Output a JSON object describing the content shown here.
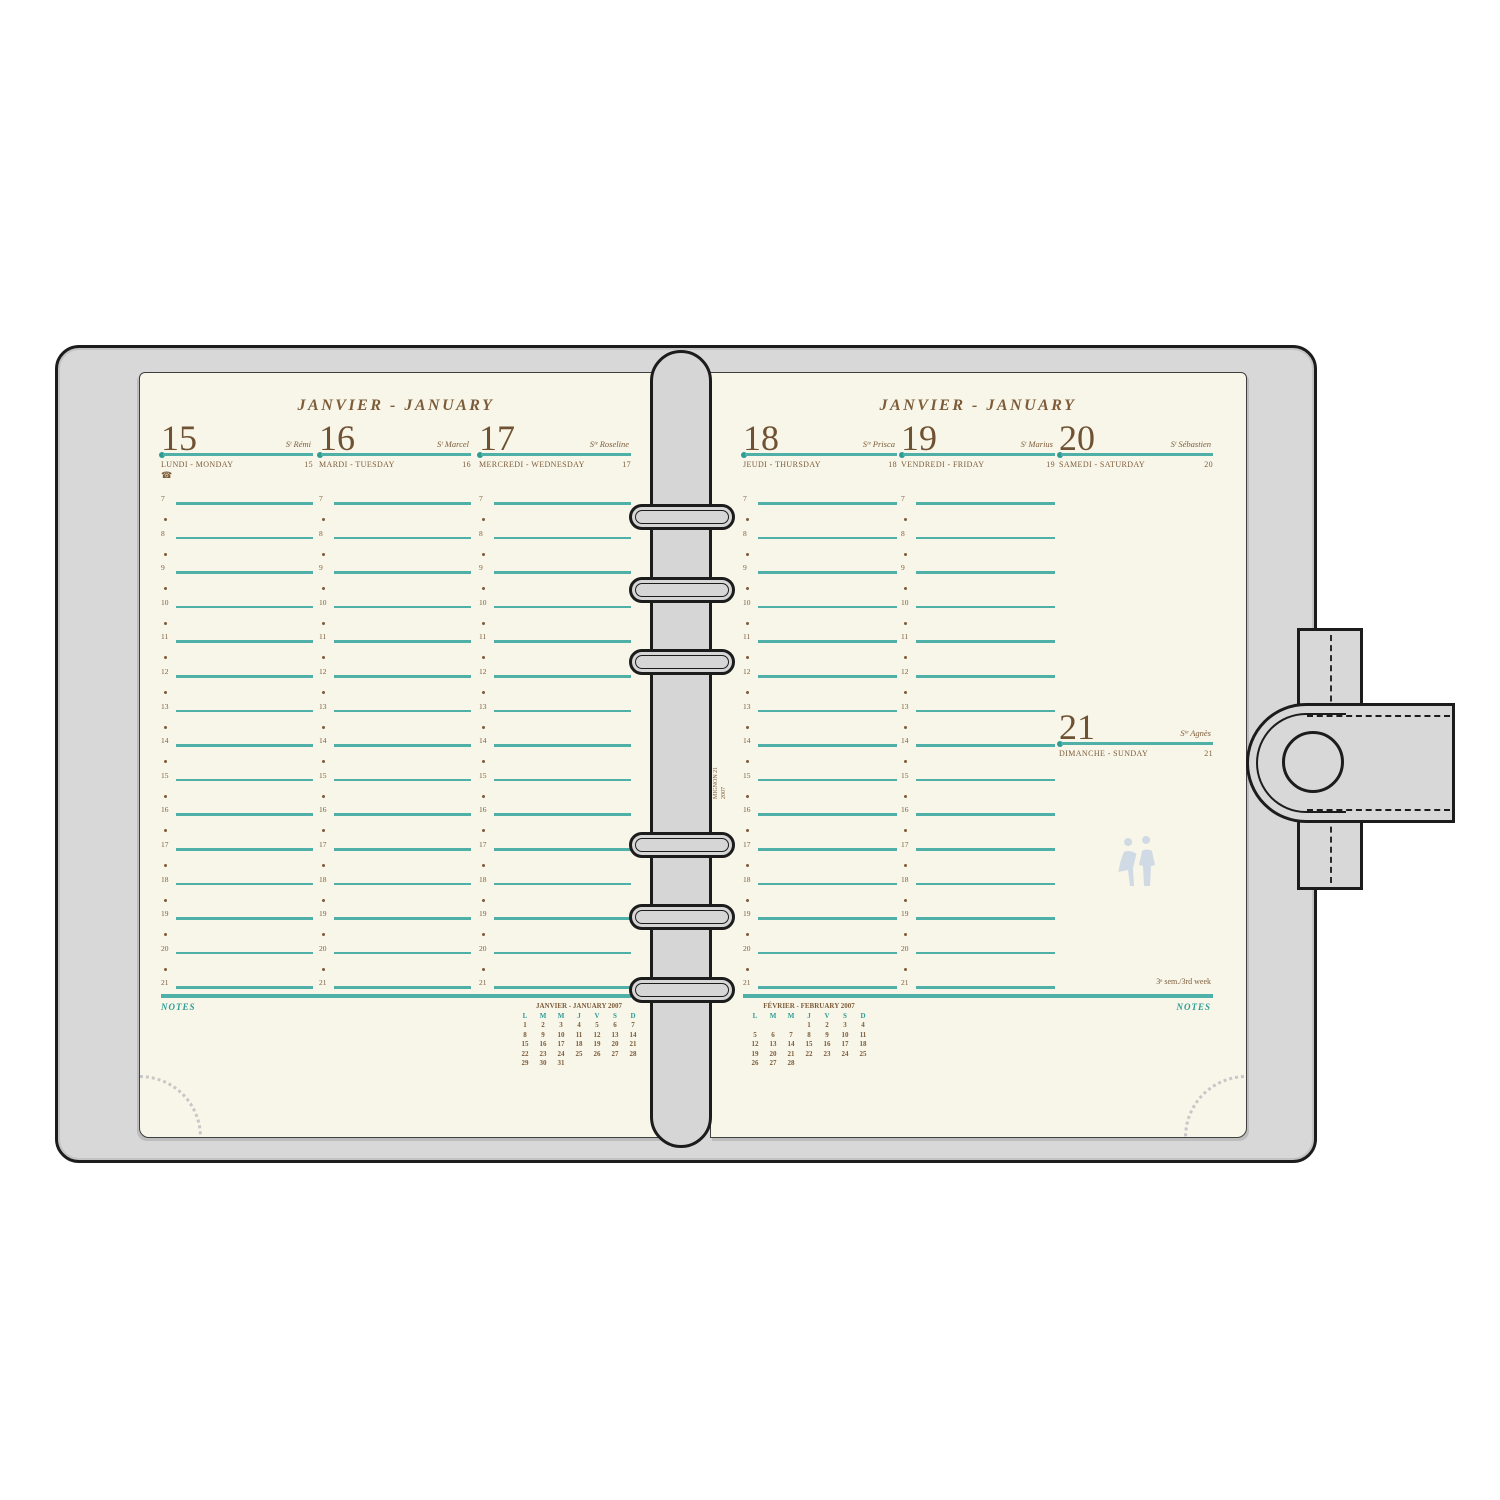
{
  "colors": {
    "teal_line": "#4fb0a8",
    "teal_text": "#2d9c95",
    "brown": "#7d5c3a",
    "brown_dark": "#6f5233",
    "page_bg": "#f8f6e9",
    "cover": "#d8d8d8",
    "outline": "#1c1c1c",
    "watermark": "#ccd8e4",
    "perforation_dots": "#c7c7c7"
  },
  "icons": {
    "phone_icon": "☎"
  },
  "planner": {
    "month_header": "JANVIER - JANUARY",
    "notes_label": "NOTES",
    "week_note": "3ᵉ sem./3rd week",
    "spine_text": [
      "MIGNON 21",
      "2007"
    ],
    "hours": [
      "7",
      "8",
      "9",
      "10",
      "11",
      "12",
      "13",
      "14",
      "15",
      "16",
      "17",
      "18",
      "19",
      "20",
      "21"
    ],
    "days": [
      {
        "num": "15",
        "saint": "Sᵗ Rémi",
        "name": "LUNDI - MONDAY",
        "day_of_year": "15",
        "page": "left",
        "col": 0,
        "block": "top",
        "hours": true,
        "phone_icon": true
      },
      {
        "num": "16",
        "saint": "Sᵗ Marcel",
        "name": "MARDI - TUESDAY",
        "day_of_year": "16",
        "page": "left",
        "col": 1,
        "block": "top",
        "hours": true,
        "phone_icon": false
      },
      {
        "num": "17",
        "saint": "Sᵗᵉ Roseline",
        "name": "MERCREDI - WEDNESDAY",
        "day_of_year": "17",
        "page": "left",
        "col": 2,
        "block": "top",
        "hours": true,
        "phone_icon": false
      },
      {
        "num": "18",
        "saint": "Sᵗᵉ Prisca",
        "name": "JEUDI - THURSDAY",
        "day_of_year": "18",
        "page": "right",
        "col": 0,
        "block": "top",
        "hours": true,
        "phone_icon": false
      },
      {
        "num": "19",
        "saint": "Sᵗ Marius",
        "name": "VENDREDI - FRIDAY",
        "day_of_year": "19",
        "page": "right",
        "col": 1,
        "block": "top",
        "hours": true,
        "phone_icon": false
      },
      {
        "num": "20",
        "saint": "Sᵗ Sébastien",
        "name": "SAMEDI - SATURDAY",
        "day_of_year": "20",
        "page": "right",
        "col": 2,
        "block": "top",
        "hours": false,
        "phone_icon": false
      },
      {
        "num": "21",
        "saint": "Sᵗᵉ Agnès",
        "name": "DIMANCHE - SUNDAY",
        "day_of_year": "21",
        "page": "right",
        "col": 2,
        "block": "mid",
        "hours": false,
        "phone_icon": false
      }
    ],
    "mini_calendars": [
      {
        "page": "left",
        "title": "JANVIER - JANUARY 2007",
        "weekdays": [
          "L",
          "M",
          "M",
          "J",
          "V",
          "S",
          "D"
        ],
        "weeks": [
          [
            "1",
            "2",
            "3",
            "4",
            "5",
            "6",
            "7"
          ],
          [
            "8",
            "9",
            "10",
            "11",
            "12",
            "13",
            "14"
          ],
          [
            "15",
            "16",
            "17",
            "18",
            "19",
            "20",
            "21"
          ],
          [
            "22",
            "23",
            "24",
            "25",
            "26",
            "27",
            "28"
          ],
          [
            "29",
            "30",
            "31",
            "",
            "",
            "",
            ""
          ]
        ]
      },
      {
        "page": "right",
        "title": "FÉVRIER - FEBRUARY 2007",
        "weekdays": [
          "L",
          "M",
          "M",
          "J",
          "V",
          "S",
          "D"
        ],
        "weeks": [
          [
            "",
            "",
            "",
            "1",
            "2",
            "3",
            "4"
          ],
          [
            "5",
            "6",
            "7",
            "8",
            "9",
            "10",
            "11"
          ],
          [
            "12",
            "13",
            "14",
            "15",
            "16",
            "17",
            "18"
          ],
          [
            "19",
            "20",
            "21",
            "22",
            "23",
            "24",
            "25"
          ],
          [
            "26",
            "27",
            "28",
            "",
            "",
            "",
            ""
          ]
        ]
      }
    ]
  }
}
